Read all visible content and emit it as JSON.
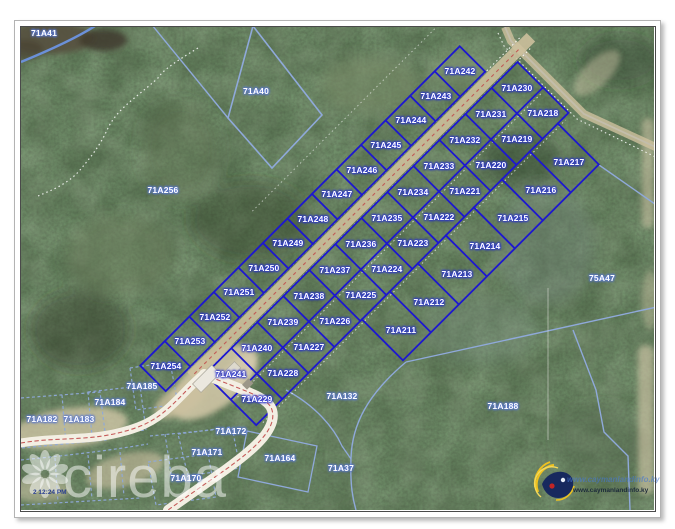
{
  "map": {
    "timestamp_fragment": "2 12:24 PM",
    "watermark_brand": "cireba",
    "logo_url_text": "www.caymanlandinfo.ky",
    "colors": {
      "subdivision_boundary": "#1d17d0",
      "parcel_boundary": "#8fa9da",
      "road_centerline": "#c04a4a",
      "label_text": "#ffffff"
    },
    "parcels": [
      {
        "id": "71A242",
        "x": 460,
        "y": 71,
        "hl": true
      },
      {
        "id": "71A243",
        "x": 436,
        "y": 96,
        "hl": true
      },
      {
        "id": "71A244",
        "x": 411,
        "y": 120,
        "hl": true
      },
      {
        "id": "71A245",
        "x": 386,
        "y": 145,
        "hl": true
      },
      {
        "id": "71A246",
        "x": 362,
        "y": 170,
        "hl": true
      },
      {
        "id": "71A247",
        "x": 337,
        "y": 194,
        "hl": true
      },
      {
        "id": "71A248",
        "x": 313,
        "y": 219,
        "hl": true
      },
      {
        "id": "71A249",
        "x": 288,
        "y": 243,
        "hl": true
      },
      {
        "id": "71A250",
        "x": 264,
        "y": 268,
        "hl": true
      },
      {
        "id": "71A251",
        "x": 239,
        "y": 292,
        "hl": true
      },
      {
        "id": "71A252",
        "x": 215,
        "y": 317,
        "hl": true
      },
      {
        "id": "71A253",
        "x": 190,
        "y": 341,
        "hl": true
      },
      {
        "id": "71A254",
        "x": 166,
        "y": 366,
        "hl": true
      },
      {
        "id": "71A230",
        "x": 517,
        "y": 88,
        "hl": true
      },
      {
        "id": "71A231",
        "x": 491,
        "y": 114,
        "hl": true
      },
      {
        "id": "71A232",
        "x": 465,
        "y": 140,
        "hl": true
      },
      {
        "id": "71A233",
        "x": 439,
        "y": 166,
        "hl": true
      },
      {
        "id": "71A234",
        "x": 413,
        "y": 192,
        "hl": true
      },
      {
        "id": "71A235",
        "x": 387,
        "y": 218,
        "hl": true
      },
      {
        "id": "71A236",
        "x": 361,
        "y": 244,
        "hl": true
      },
      {
        "id": "71A237",
        "x": 335,
        "y": 270,
        "hl": true
      },
      {
        "id": "71A238",
        "x": 309,
        "y": 296,
        "hl": true
      },
      {
        "id": "71A239",
        "x": 283,
        "y": 322,
        "hl": true
      },
      {
        "id": "71A240",
        "x": 257,
        "y": 348,
        "hl": true
      },
      {
        "id": "71A241",
        "x": 231,
        "y": 374,
        "hl": true
      },
      {
        "id": "71A218",
        "x": 543,
        "y": 113,
        "hl": true
      },
      {
        "id": "71A219",
        "x": 517,
        "y": 139,
        "hl": true
      },
      {
        "id": "71A220",
        "x": 491,
        "y": 165,
        "hl": true
      },
      {
        "id": "71A221",
        "x": 465,
        "y": 191,
        "hl": true
      },
      {
        "id": "71A222",
        "x": 439,
        "y": 217,
        "hl": true
      },
      {
        "id": "71A223",
        "x": 413,
        "y": 243,
        "hl": true
      },
      {
        "id": "71A224",
        "x": 387,
        "y": 269,
        "hl": true
      },
      {
        "id": "71A225",
        "x": 361,
        "y": 295,
        "hl": true
      },
      {
        "id": "71A226",
        "x": 335,
        "y": 321,
        "hl": true
      },
      {
        "id": "71A227",
        "x": 309,
        "y": 347,
        "hl": true
      },
      {
        "id": "71A228",
        "x": 283,
        "y": 373,
        "hl": true
      },
      {
        "id": "71A229",
        "x": 257,
        "y": 399,
        "hl": true
      },
      {
        "id": "71A217",
        "x": 569,
        "y": 162,
        "hl": true
      },
      {
        "id": "71A216",
        "x": 541,
        "y": 190,
        "hl": true
      },
      {
        "id": "71A215",
        "x": 513,
        "y": 218,
        "hl": true
      },
      {
        "id": "71A214",
        "x": 485,
        "y": 246,
        "hl": true
      },
      {
        "id": "71A213",
        "x": 457,
        "y": 274,
        "hl": true
      },
      {
        "id": "71A212",
        "x": 429,
        "y": 302,
        "hl": true
      },
      {
        "id": "71A211",
        "x": 401,
        "y": 330,
        "hl": true
      },
      {
        "id": "71A41",
        "x": 44,
        "y": 33,
        "hl": false
      },
      {
        "id": "71A40",
        "x": 256,
        "y": 91,
        "hl": false
      },
      {
        "id": "71A256",
        "x": 163,
        "y": 190,
        "hl": false
      },
      {
        "id": "75A47",
        "x": 602,
        "y": 278,
        "hl": false
      },
      {
        "id": "71A185",
        "x": 142,
        "y": 386,
        "hl": false
      },
      {
        "id": "71A184",
        "x": 110,
        "y": 402,
        "hl": false
      },
      {
        "id": "71A183",
        "x": 79,
        "y": 419,
        "hl": false
      },
      {
        "id": "71A182",
        "x": 42,
        "y": 419,
        "hl": false
      },
      {
        "id": "71A172",
        "x": 231,
        "y": 431,
        "hl": false
      },
      {
        "id": "71A171",
        "x": 207,
        "y": 452,
        "hl": false
      },
      {
        "id": "71A170",
        "x": 186,
        "y": 478,
        "hl": false
      },
      {
        "id": "71A164",
        "x": 280,
        "y": 458,
        "hl": false
      },
      {
        "id": "71A132",
        "x": 342,
        "y": 396,
        "hl": false
      },
      {
        "id": "71A37",
        "x": 341,
        "y": 468,
        "hl": false
      },
      {
        "id": "71A188",
        "x": 503,
        "y": 406,
        "hl": false
      }
    ]
  }
}
